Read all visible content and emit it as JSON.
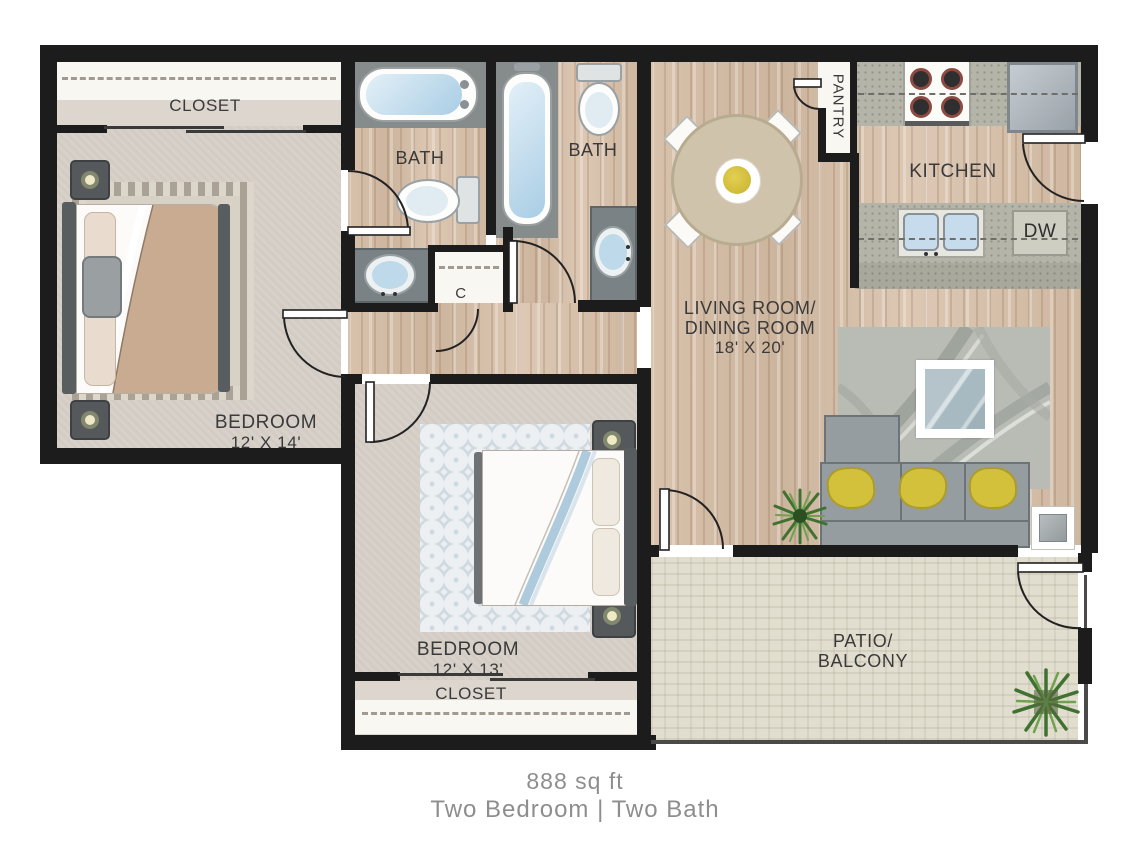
{
  "floorplan": {
    "labels": {
      "closet_top": "CLOSET",
      "closet_bottom": "CLOSET",
      "closet_hall": "C",
      "bath_master": "BATH",
      "bath_hall": "BATH",
      "pantry": "PANTRY",
      "kitchen": "KITCHEN",
      "dishwasher": "DW",
      "living_line1": "LIVING ROOM/",
      "living_line2": "DINING ROOM",
      "living_dims": "18' X 20'",
      "bedroom1_name": "BEDROOM",
      "bedroom1_dims": "12' X 14'",
      "bedroom2_name": "BEDROOM",
      "bedroom2_dims": "12' X 13'",
      "patio_line1": "PATIO/",
      "patio_line2": "BALCONY"
    },
    "caption": {
      "line1": "888 sq ft",
      "line2": "Two Bedroom | Two Bath"
    },
    "colors": {
      "wall": "#1c1c1c",
      "wood_floor": "#d5bfa9",
      "carpet": "#d7d1ca",
      "bath_tile": "#868c8b",
      "patio_stone": "#e2decf",
      "pillow_accent": "#d3c13b",
      "water": "#a9cde5",
      "caption_text": "#8e8e8e"
    }
  }
}
